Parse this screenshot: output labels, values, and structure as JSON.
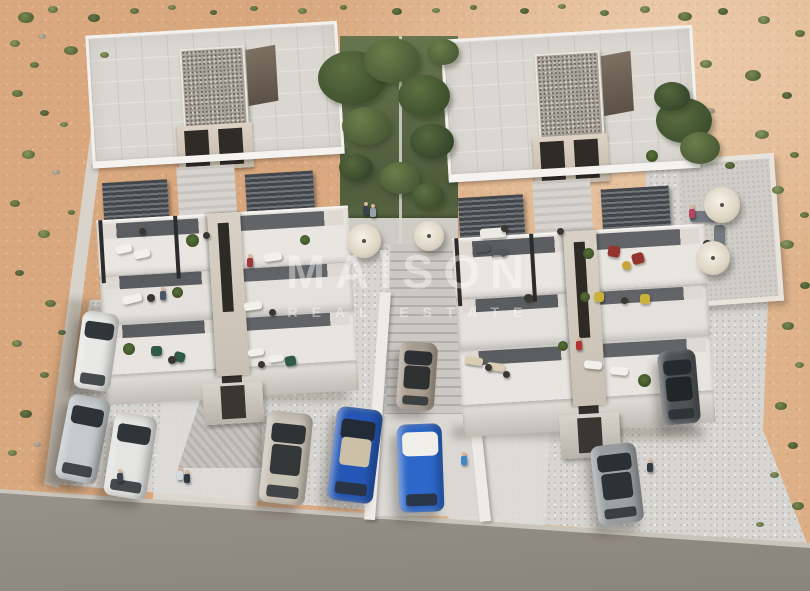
{
  "watermark": {
    "title": "MAISON",
    "subtitle": "REAL ESTATE"
  },
  "palette": {
    "sand": "#d9a87e",
    "sand_light": "#e3bc97",
    "pavement": "#d7d5d1",
    "road": "#a49d97",
    "building": "#e9e6e1",
    "building_shadow": "#c4bfb8",
    "pergola": "#45494d",
    "garden_green": "#5c6a44",
    "car_blue": "#2457b5",
    "watermark_white": "#ffffff"
  },
  "scene": {
    "shrubs": [
      [
        18,
        12,
        16,
        0
      ],
      [
        48,
        6,
        10,
        1
      ],
      [
        88,
        14,
        12,
        2
      ],
      [
        10,
        40,
        10,
        1
      ],
      [
        38,
        34,
        8,
        3
      ],
      [
        64,
        46,
        14,
        0
      ],
      [
        100,
        52,
        9,
        1
      ],
      [
        130,
        8,
        9,
        0
      ],
      [
        168,
        5,
        8,
        1
      ],
      [
        210,
        10,
        7,
        2
      ],
      [
        250,
        6,
        8,
        0
      ],
      [
        298,
        8,
        9,
        1
      ],
      [
        340,
        5,
        7,
        0
      ],
      [
        392,
        8,
        10,
        2
      ],
      [
        432,
        8,
        8,
        1
      ],
      [
        470,
        5,
        7,
        0
      ],
      [
        520,
        8,
        9,
        2
      ],
      [
        558,
        4,
        8,
        1
      ],
      [
        600,
        10,
        9,
        0
      ],
      [
        640,
        6,
        10,
        1
      ],
      [
        678,
        12,
        14,
        0
      ],
      [
        718,
        8,
        10,
        2
      ],
      [
        758,
        16,
        12,
        1
      ],
      [
        795,
        30,
        10,
        0
      ],
      [
        700,
        60,
        12,
        1
      ],
      [
        745,
        70,
        16,
        0
      ],
      [
        782,
        92,
        10,
        2
      ],
      [
        706,
        108,
        9,
        3
      ],
      [
        755,
        130,
        14,
        1
      ],
      [
        790,
        152,
        9,
        0
      ],
      [
        725,
        162,
        10,
        2
      ],
      [
        772,
        186,
        12,
        1
      ],
      [
        800,
        212,
        9,
        0
      ],
      [
        780,
        240,
        14,
        1
      ],
      [
        800,
        282,
        10,
        2
      ],
      [
        782,
        322,
        12,
        0
      ],
      [
        795,
        362,
        9,
        1
      ],
      [
        775,
        402,
        12,
        0
      ],
      [
        788,
        442,
        10,
        2
      ],
      [
        770,
        472,
        9,
        1
      ],
      [
        792,
        502,
        12,
        0
      ],
      [
        756,
        522,
        8,
        1
      ],
      [
        12,
        90,
        11,
        0
      ],
      [
        40,
        110,
        9,
        2
      ],
      [
        22,
        150,
        13,
        1
      ],
      [
        52,
        170,
        8,
        3
      ],
      [
        10,
        200,
        10,
        0
      ],
      [
        38,
        230,
        12,
        1
      ],
      [
        15,
        270,
        9,
        2
      ],
      [
        45,
        300,
        11,
        0
      ],
      [
        12,
        340,
        10,
        1
      ],
      [
        40,
        372,
        9,
        0
      ],
      [
        20,
        410,
        12,
        2
      ],
      [
        8,
        450,
        9,
        1
      ],
      [
        34,
        442,
        7,
        3
      ],
      [
        60,
        122,
        8,
        1
      ],
      [
        68,
        210,
        7,
        0
      ],
      [
        58,
        330,
        8,
        2
      ],
      [
        30,
        62,
        9,
        0
      ]
    ],
    "trees": [
      [
        352,
        78,
        34,
        0
      ],
      [
        392,
        60,
        28,
        1
      ],
      [
        424,
        96,
        26,
        0
      ],
      [
        366,
        126,
        24,
        1
      ],
      [
        432,
        142,
        22,
        2
      ],
      [
        400,
        178,
        20,
        1
      ],
      [
        356,
        168,
        17,
        2
      ],
      [
        428,
        196,
        16,
        0
      ],
      [
        684,
        120,
        28,
        0
      ],
      [
        700,
        148,
        20,
        1
      ],
      [
        672,
        96,
        18,
        2
      ],
      [
        443,
        52,
        16,
        1
      ]
    ],
    "cars": [
      [
        78,
        312,
        37,
        78,
        8,
        "#e8e9e7",
        ""
      ],
      [
        62,
        396,
        42,
        86,
        11,
        "#c6cacc",
        ""
      ],
      [
        109,
        414,
        43,
        84,
        9,
        "#e4e4e2",
        ""
      ],
      [
        263,
        412,
        46,
        92,
        6,
        "#c9c2b6",
        "dark"
      ],
      [
        398,
        342,
        38,
        68,
        4,
        "#ab9f91",
        "dark"
      ],
      [
        332,
        408,
        46,
        94,
        7,
        "#2457b5",
        "tan"
      ],
      [
        398,
        424,
        45,
        88,
        -2,
        "#2c67c9",
        "white"
      ],
      [
        660,
        350,
        38,
        74,
        -5,
        "#4f5356",
        "dark"
      ],
      [
        594,
        444,
        46,
        80,
        -7,
        "#9da1a4",
        "dark"
      ]
    ],
    "furniture": [
      [
        "lw",
        116,
        245,
        16,
        8,
        -12
      ],
      [
        "lw",
        134,
        250,
        16,
        8,
        -12
      ],
      [
        "lw",
        264,
        253,
        18,
        8,
        -8
      ],
      [
        "lw",
        122,
        295,
        20,
        8,
        -14
      ],
      [
        "lw",
        244,
        302,
        18,
        8,
        -8
      ],
      [
        "lw",
        248,
        349,
        16,
        7,
        -8
      ],
      [
        "lw",
        268,
        355,
        16,
        7,
        -8
      ],
      [
        "cg",
        151,
        346,
        11,
        10,
        0
      ],
      [
        "cg",
        174,
        352,
        11,
        10,
        15
      ],
      [
        "cg",
        285,
        356,
        11,
        10,
        -10
      ],
      [
        "td",
        147,
        294,
        8,
        8,
        0
      ],
      [
        "td",
        168,
        356,
        8,
        8,
        0
      ],
      [
        "td",
        258,
        361,
        7,
        7,
        0
      ],
      [
        "td",
        269,
        309,
        7,
        7,
        0
      ],
      [
        "td",
        139,
        228,
        7,
        7,
        0
      ],
      [
        "td",
        203,
        232,
        7,
        7,
        0
      ],
      [
        "pl",
        186,
        234,
        13,
        13,
        0
      ],
      [
        "pl",
        172,
        287,
        11,
        11,
        0
      ],
      [
        "pl",
        123,
        343,
        12,
        12,
        0
      ],
      [
        "pl",
        300,
        235,
        10,
        10,
        0
      ],
      [
        "sw",
        480,
        228,
        26,
        10,
        -4
      ],
      [
        "td",
        501,
        225,
        7,
        7,
        0
      ],
      [
        "td",
        557,
        228,
        7,
        7,
        0
      ],
      [
        "ld",
        474,
        244,
        16,
        8,
        -6
      ],
      [
        "ld",
        491,
        249,
        16,
        8,
        -6
      ],
      [
        "cr",
        608,
        246,
        12,
        11,
        10
      ],
      [
        "cr",
        632,
        253,
        12,
        11,
        -15
      ],
      [
        "ty",
        622,
        261,
        9,
        9,
        0
      ],
      [
        "pl",
        583,
        248,
        11,
        11,
        0
      ],
      [
        "cy",
        594,
        292,
        10,
        10,
        0
      ],
      [
        "cy",
        640,
        294,
        10,
        10,
        0
      ],
      [
        "td",
        621,
        297,
        7,
        7,
        0
      ],
      [
        "td",
        524,
        294,
        9,
        8,
        0
      ],
      [
        "pl",
        580,
        292,
        10,
        10,
        0
      ],
      [
        "lb",
        465,
        357,
        18,
        8,
        8
      ],
      [
        "lb",
        487,
        363,
        18,
        8,
        8
      ],
      [
        "td",
        485,
        364,
        7,
        7,
        0
      ],
      [
        "td",
        503,
        371,
        7,
        7,
        0
      ],
      [
        "lw",
        584,
        361,
        18,
        8,
        6
      ],
      [
        "lw",
        610,
        367,
        18,
        8,
        6
      ],
      [
        "pl",
        638,
        374,
        13,
        13,
        0
      ],
      [
        "pl",
        558,
        341,
        10,
        10,
        0
      ],
      [
        "sg",
        690,
        211,
        26,
        11,
        0
      ],
      [
        "sg",
        714,
        225,
        11,
        22,
        0
      ],
      [
        "td",
        703,
        240,
        9,
        7,
        0
      ],
      [
        "um",
        347,
        224,
        34,
        34,
        0
      ],
      [
        "um",
        414,
        221,
        30,
        30,
        0
      ],
      [
        "um",
        704,
        187,
        36,
        36,
        0
      ],
      [
        "um",
        696,
        241,
        34,
        34,
        0
      ],
      [
        "pl",
        646,
        150,
        12,
        12,
        0
      ]
    ],
    "people": [
      [
        362,
        202,
        "#37424c"
      ],
      [
        369,
        204,
        "#97a0ab"
      ],
      [
        246,
        254,
        "#a23535"
      ],
      [
        159,
        287,
        "#4a5568"
      ],
      [
        575,
        337,
        "#b03232"
      ],
      [
        116,
        469,
        "#3c4450"
      ],
      [
        176,
        467,
        "#d3d9df"
      ],
      [
        183,
        470,
        "#2f3842"
      ],
      [
        460,
        452,
        "#3f86c9"
      ],
      [
        646,
        459,
        "#343b44"
      ],
      [
        688,
        205,
        "#b8445f"
      ]
    ]
  }
}
